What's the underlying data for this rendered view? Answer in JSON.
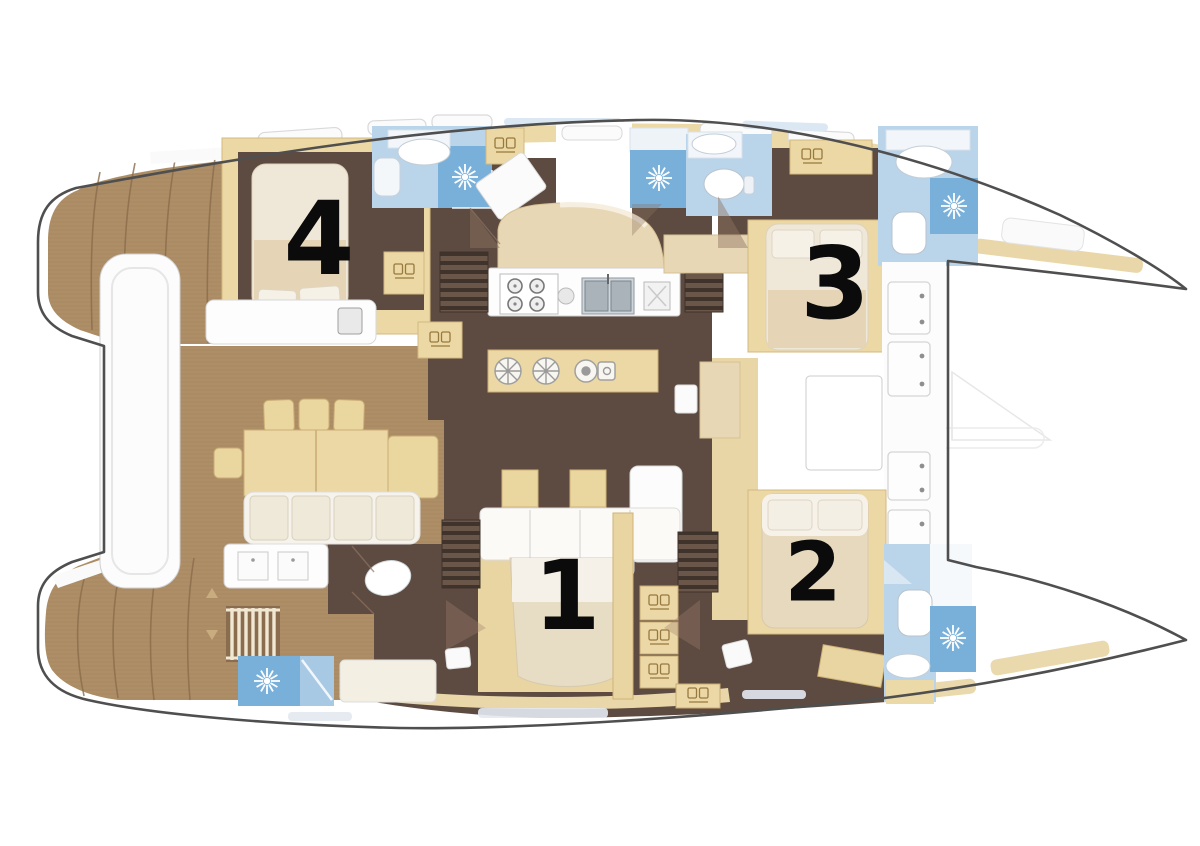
{
  "diagram": {
    "kind": "catamaran-yacht-floor-plan",
    "cabins": [
      {
        "label": "1"
      },
      {
        "label": "2"
      },
      {
        "label": "3"
      },
      {
        "label": "4"
      }
    ]
  },
  "colors": {
    "background": "#ffffff",
    "hull_outline": "#4f4f4f",
    "teak_deck": "#ae8e67",
    "teak_grain": "#9c7b53",
    "interior_floor": "#5d4b41",
    "stair_dark": "#3f332c",
    "stair_light": "#6b574a",
    "furniture_tan": "#ecd8a4",
    "furniture_cream": "#efe8d8",
    "bed_cream": "#e4d4b4",
    "bathroom_blue": "#bad4ea",
    "shower_blue": "#79b0da",
    "fixture_white": "#fdfdfd",
    "cabin_number": "#0b0b0b"
  },
  "icons": {
    "shower": "shower-starburst-icon",
    "toilet": "toilet-icon",
    "sink": "sink-icon",
    "stove": "stove-burners-icon",
    "double_sink": "double-sink-icon",
    "stairs": "stairs-icon",
    "ladder": "ladder-icon",
    "locker": "locker-vent-icon"
  }
}
